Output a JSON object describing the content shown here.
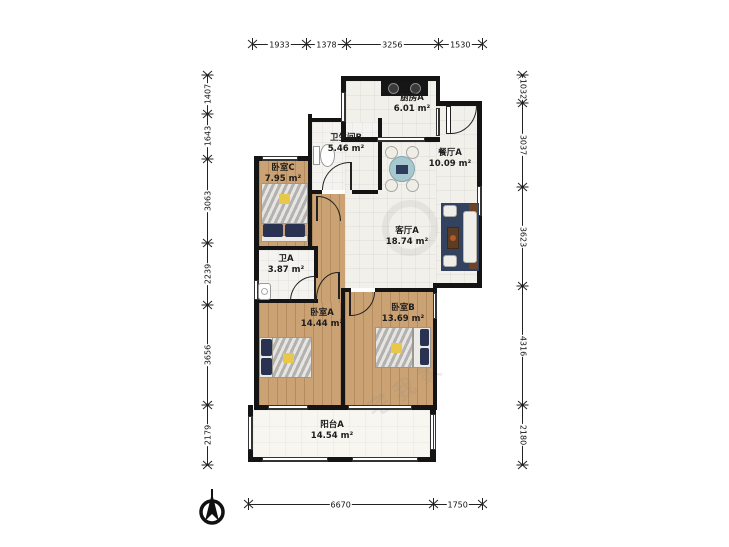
{
  "plan": {
    "rooms": {
      "kitchen": {
        "name": "厨房A",
        "area": "6.01 m²"
      },
      "bath_b": {
        "name": "卫生间B",
        "area": "5.46 m²"
      },
      "dining": {
        "name": "餐厅A",
        "area": "10.09 m²"
      },
      "bed_c": {
        "name": "卧室C",
        "area": "7.95 m²"
      },
      "living": {
        "name": "客厅A",
        "area": "18.74 m²"
      },
      "bath_a": {
        "name": "卫A",
        "area": "3.87 m²"
      },
      "bed_a": {
        "name": "卧室A",
        "area": "14.44 m²"
      },
      "bed_b": {
        "name": "卧室B",
        "area": "13.69 m²"
      },
      "balcony": {
        "name": "阳台A",
        "area": "14.54 m²"
      }
    },
    "dimensions": {
      "top": [
        1933,
        1378,
        3256,
        1530
      ],
      "left": [
        1407,
        1643,
        3063,
        2239,
        3656,
        2179
      ],
      "right": [
        1032,
        3037,
        3623,
        4316,
        2180
      ],
      "bottom": [
        6670,
        1750
      ]
    },
    "watermark": "宅我家",
    "colors": {
      "wall": "#141414",
      "wood_floor": "#cba273",
      "tile_floor": "#f1f0ea",
      "rug": "#33425f",
      "dining_table": "#a8c8d0",
      "pillow_navy": "#2a3252",
      "accent_yellow": "#e7c84a"
    }
  }
}
